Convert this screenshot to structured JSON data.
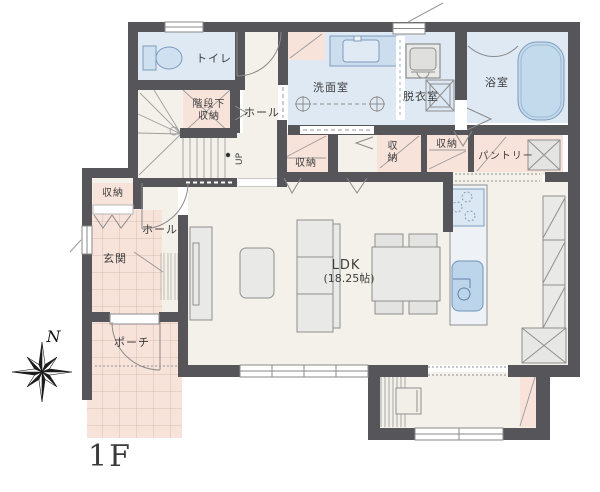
{
  "compass": {
    "north_label": "N"
  },
  "floor_label": "1F",
  "rooms": {
    "toilet": "トイレ",
    "hall_upper": "ホール",
    "under_stair_storage_line1": "階段下",
    "under_stair_storage_line2": "収納",
    "stairs_up": "UP",
    "washroom": "洗面室",
    "dressing_room": "脱衣室",
    "bathroom": "浴室",
    "storage_hall": "収納",
    "storage_mid": "収納",
    "storage_side": "収納",
    "pantry": "パントリー",
    "storage_entrance": "収納",
    "entrance": "玄関",
    "hall_lower": "ホール",
    "ldk_name": "LDK",
    "ldk_size": "(18.25帖)",
    "porch": "ポーチ"
  },
  "colors": {
    "wall": "#56565a",
    "floor": "#f4f1ea",
    "wet_room_floor": "#dfe9f3",
    "storage_floor": "#f8e3da",
    "tile_line": "#d8bcae",
    "fixture_blue": "#c6dbee",
    "fixture_blue_stroke": "#7d9cbd",
    "furniture_fill": "#e9e9e7",
    "line_gray": "#8f8f8f",
    "text": "#3d3d3d",
    "background": "#ffffff"
  }
}
